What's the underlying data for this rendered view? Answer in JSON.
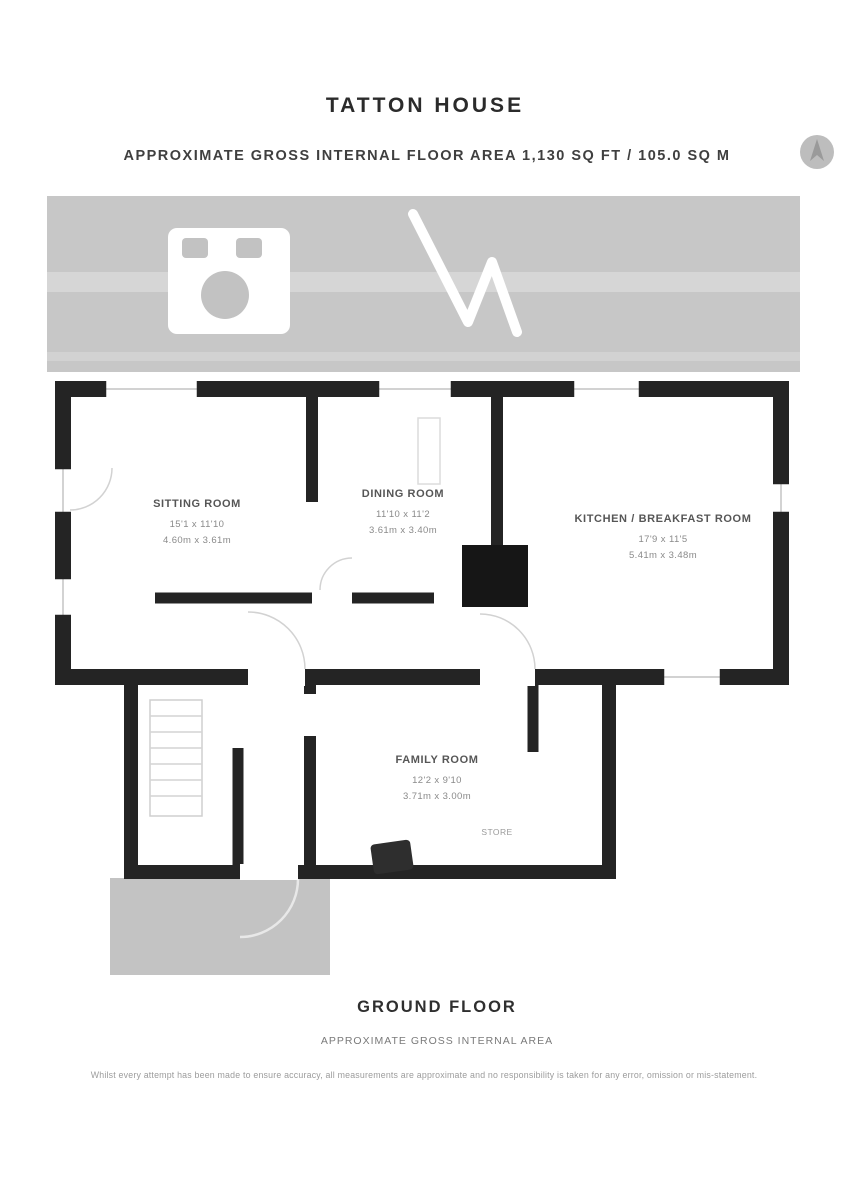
{
  "header": {
    "title": "TATTON HOUSE",
    "subtitle": "APPROXIMATE GROSS INTERNAL FLOOR AREA 1,130 SQ FT / 105.0 SQ M"
  },
  "plan": {
    "colors": {
      "wall": "#242424",
      "terrace_fill": "#c7c7c7",
      "terrace_stripe": "#d6d6d6",
      "porch_fill": "#c3c3c3",
      "fireplace_fill": "#161616"
    },
    "rooms": [
      {
        "id": "sitting",
        "name": "SITTING ROOM",
        "dims_ft": "15'1 x 11'10",
        "dims_m": "4.60m x 3.61m"
      },
      {
        "id": "dining",
        "name": "DINING ROOM",
        "dims_ft": "11'10 x 11'2",
        "dims_m": "3.61m x 3.40m"
      },
      {
        "id": "kitchen",
        "name": "KITCHEN / BREAKFAST ROOM",
        "dims_ft": "17'9 x 11'5",
        "dims_m": "5.41m x 3.48m"
      },
      {
        "id": "family",
        "name": "FAMILY ROOM",
        "dims_ft": "12'2 x 9'10",
        "dims_m": "3.71m x 3.00m"
      },
      {
        "id": "store",
        "name": "STORE"
      }
    ]
  },
  "footer": {
    "floor_label": "GROUND FLOOR",
    "floor_sublabel": "APPROXIMATE GROSS INTERNAL AREA",
    "disclaimer": "Whilst every attempt has been made to ensure accuracy, all measurements are approximate and no responsibility is taken for any error, omission or mis-statement."
  }
}
